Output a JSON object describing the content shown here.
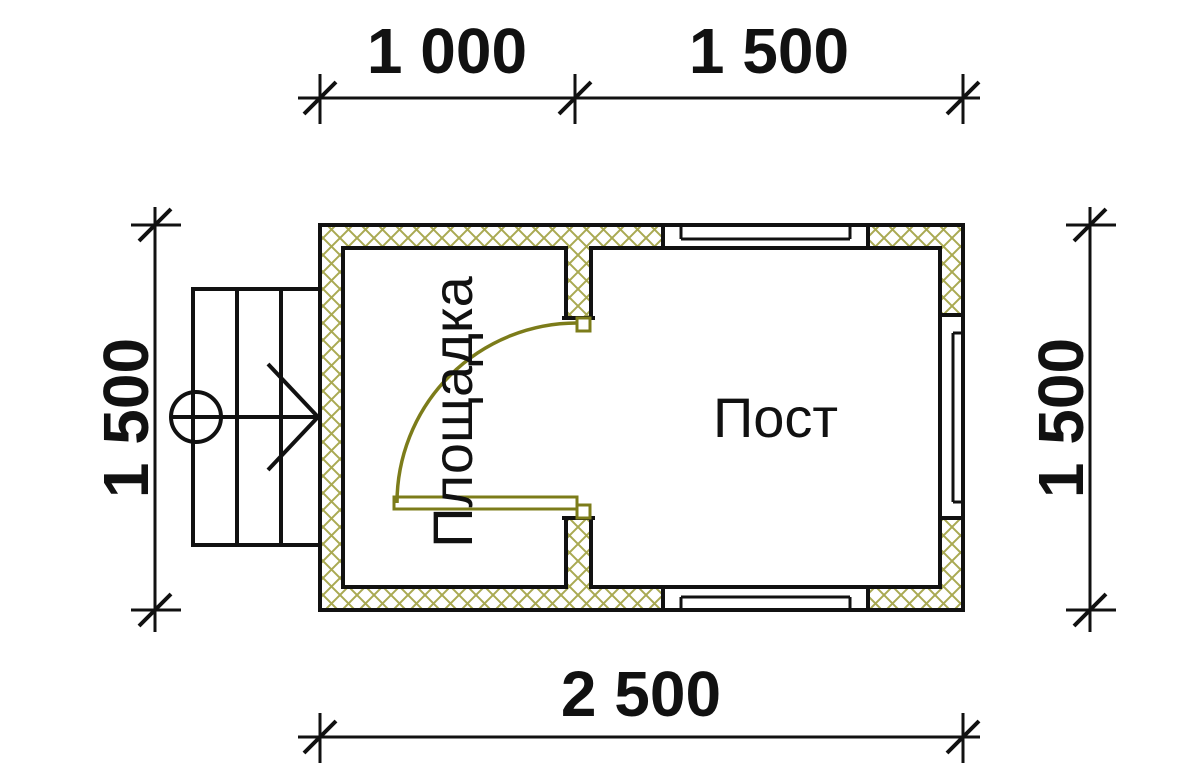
{
  "drawing": {
    "title": "floor plan with dimensions",
    "dimensions": {
      "top_left": "1 000",
      "top_right": "1 500",
      "bottom": "2 500",
      "left": "1 500",
      "right": "1 500"
    },
    "rooms": {
      "left": "Площадка",
      "right": "Пост"
    },
    "watermark": {
      "part1": "VAN",
      "part2": "DA"
    }
  },
  "colors": {
    "hatch": "#a9a952",
    "door": "#7c7c1a",
    "wm_pink_front": "#f6cbd4",
    "wm_pink_top": "#f9dce2",
    "wm_blue_front": "#d3e5f5",
    "wm_blue_top": "#dceefb",
    "wm_letters": "#ffffff"
  }
}
